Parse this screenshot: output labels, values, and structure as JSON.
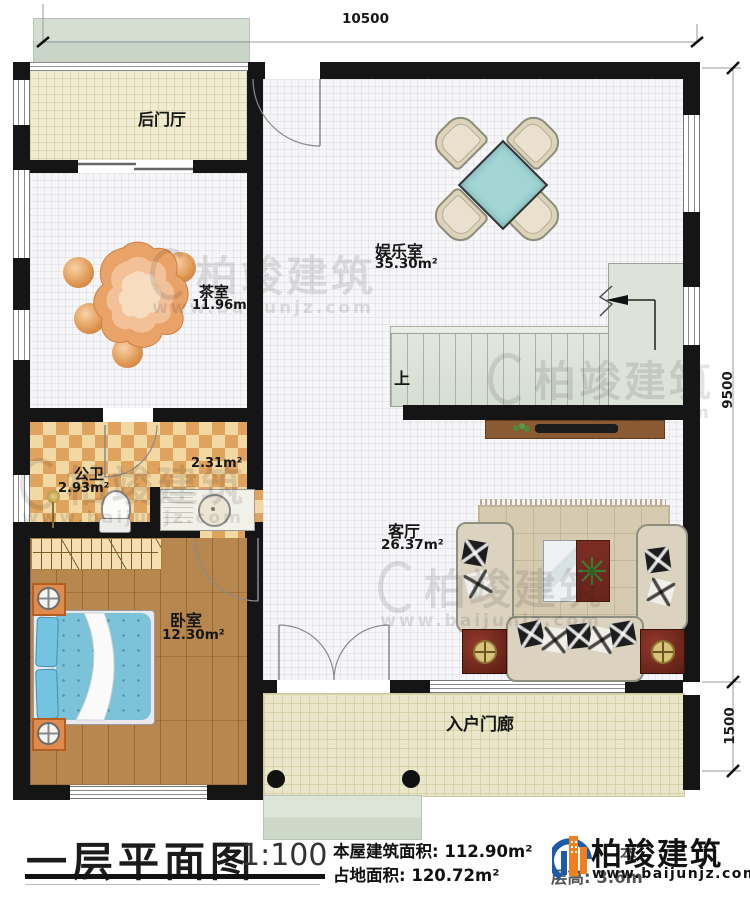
{
  "dimensions": {
    "top": "10500",
    "right_main": "9500",
    "right_porch": "1500"
  },
  "rooms": {
    "back_hall": {
      "label": "后门厅"
    },
    "tea_room": {
      "label": "茶室",
      "area": "11.96m²"
    },
    "game_room": {
      "label": "娱乐室",
      "area": "35.30m²"
    },
    "bathroom": {
      "label": "公卫",
      "area": "2.93m²",
      "sub_area": "2.31m²"
    },
    "bedroom": {
      "label": "卧室",
      "area": "12.30m²"
    },
    "living_room": {
      "label": "客厅",
      "area": "26.37m²"
    },
    "porch": {
      "label": "入户门廊"
    },
    "stairs": {
      "label": "上"
    }
  },
  "title_block": {
    "title": "一层平面图",
    "scale": "1:100",
    "building_area": "本屋建筑面积: 112.90m²",
    "land_area": "占地面积: 120.72m²",
    "hidden_fragment": "本",
    "floor_height": "层高: 3.6m"
  },
  "brand": {
    "name": "柏竣建筑",
    "website": "www.baijunjz.com"
  },
  "watermark": {
    "name": "柏竣建筑",
    "website": "www.baijunjz.com"
  },
  "colors": {
    "wall": "#151515",
    "brand_blue": "#1c5ca6",
    "brand_orange": "#f07f1f"
  }
}
